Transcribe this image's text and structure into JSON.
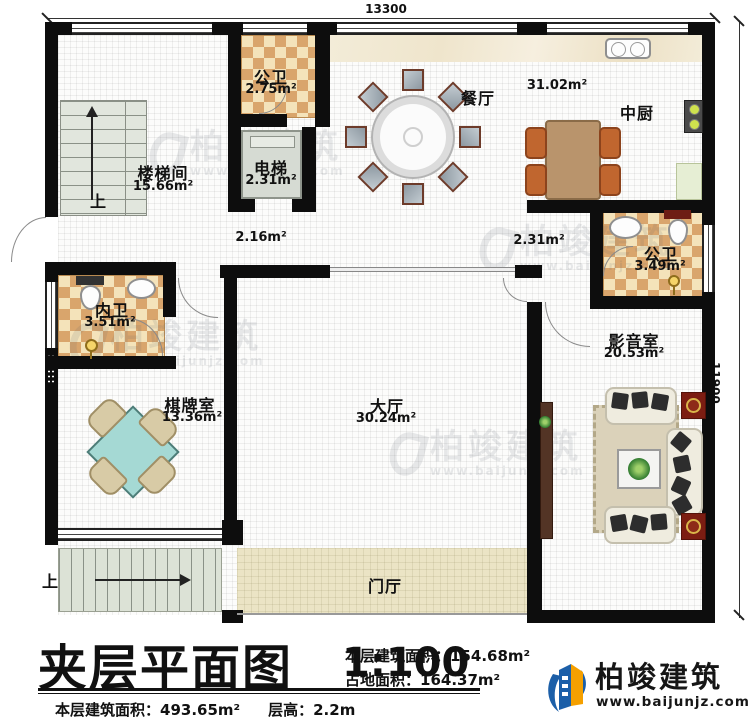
{
  "dimensions": {
    "top": "13300",
    "right": "11900"
  },
  "rooms": [
    {
      "id": "stairwell",
      "name": "楼梯间",
      "area": "15.66m²"
    },
    {
      "id": "public-bath-top",
      "name": "公卫",
      "area": "2.75m²"
    },
    {
      "id": "elevator",
      "name": "电梯",
      "area": "2.31m²"
    },
    {
      "id": "dining",
      "name": "餐厅",
      "area": "31.02m²"
    },
    {
      "id": "kitchen",
      "name": "中厨",
      "area": ""
    },
    {
      "id": "corridor-left",
      "name": "",
      "area": "2.16m²"
    },
    {
      "id": "corridor-right",
      "name": "",
      "area": "2.31m²"
    },
    {
      "id": "public-bath-right",
      "name": "公卫",
      "area": "3.49m²"
    },
    {
      "id": "inner-bath",
      "name": "内卫",
      "area": "3.51m²"
    },
    {
      "id": "chess-room",
      "name": "棋牌室",
      "area": "13.36m²"
    },
    {
      "id": "hall",
      "name": "大厅",
      "area": "30.24m²"
    },
    {
      "id": "media-room",
      "name": "影音室",
      "area": "20.53m²"
    },
    {
      "id": "foyer",
      "name": "门厅",
      "area": ""
    }
  ],
  "stairs": {
    "up_top": "上",
    "up_bottom": "上"
  },
  "title_block": {
    "title": "夹层平面图",
    "scale": "1:100",
    "floor_area_label": "本层建筑面积：",
    "floor_area_value": "154.68m²",
    "land_area_label": "占地面积：",
    "land_area_value": "164.37m²",
    "total_area_label": "本层建筑面积：",
    "total_area_value": "493.65m²",
    "height_label": "层高：",
    "height_value": "2.2m"
  },
  "brand": {
    "name": "柏竣建筑",
    "website": "www.baijunjz.com",
    "blue": "#1c5fa8",
    "orange": "#f5a000"
  },
  "watermark": {
    "text": "柏竣建筑",
    "site": "www.baijunjz.com"
  },
  "colors": {
    "wall": "#0d0d0d",
    "bath_tile_dark": "#d9a56c",
    "bath_tile_light": "#f4e3ba",
    "foyer_floor": "#ebe4c5",
    "stair_tread": "#dce2d6",
    "mahjong_table": "#a5d9d4",
    "sofa": "#efecdf",
    "accent_red_table": "#7c1d12"
  }
}
